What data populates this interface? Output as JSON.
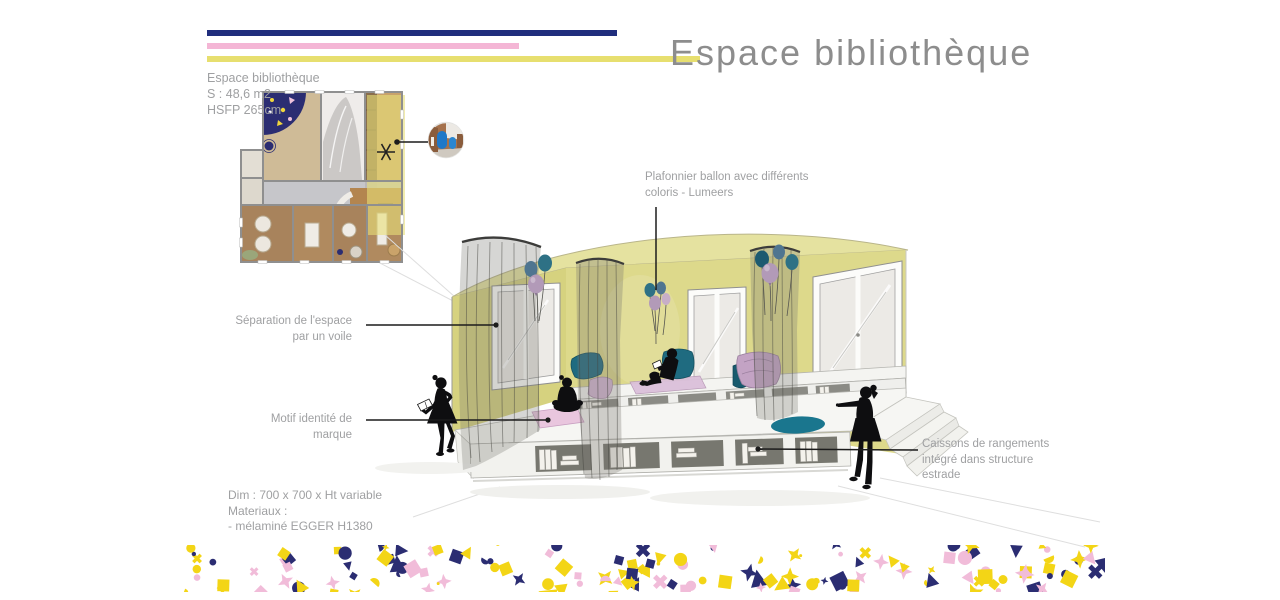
{
  "header": {
    "title": "Espace bibliothèque"
  },
  "info": {
    "lines": [
      "Espace bibliothèque",
      "S : 48,6 m2",
      "HSFP 265cm"
    ]
  },
  "annotations": {
    "plafonnier": {
      "lines": [
        "Plafonnier ballon avec différents",
        "coloris - Lumeers"
      ]
    },
    "separation": {
      "lines": [
        "Séparation de l'espace",
        "par un voile"
      ]
    },
    "motif": {
      "lines": [
        "Motif identité de",
        "marque"
      ]
    },
    "caissons": {
      "lines": [
        "Caissons de rangements",
        "intégré dans structure",
        "estrade"
      ]
    }
  },
  "specs": {
    "lines": [
      "Dim : 700 x 700 x Ht variable",
      "Materiaux :",
      "- mélaminé EGGER H1380"
    ]
  },
  "colors": {
    "accent-navy": "#202e7d",
    "accent-pink": "#f4b6d5",
    "accent-yellow": "#e7df6f",
    "wall-yellow": "#ddd98b",
    "wall-yellow-dark": "#d6d27f",
    "ceiling-yellow": "#e5e2a0",
    "balloon-teal": "#2e7185",
    "balloon-teal-dark": "#1d5a70",
    "balloon-mauve": "#b29ab8",
    "balloon-slate": "#4f7590",
    "cushion-teal": "#1f6b80",
    "cushion-mauve": "#c3a3c4",
    "mat-pink": "#e9c6de",
    "rug-teal": "#1a768e",
    "silhouette-black": "#0e0e10",
    "text-gray": "#9fa0a2",
    "title-gray": "#8d8d8d",
    "line-black": "#1c1c1c",
    "plan-navy": "#2b2d72",
    "plan-wood": "#a8835c",
    "inset-wood": "#a5714c",
    "inset-blue": "#1f78c8"
  },
  "confetti": {
    "colors": [
      "#f3d516",
      "#2b2d72",
      "#f1bcd9"
    ]
  }
}
